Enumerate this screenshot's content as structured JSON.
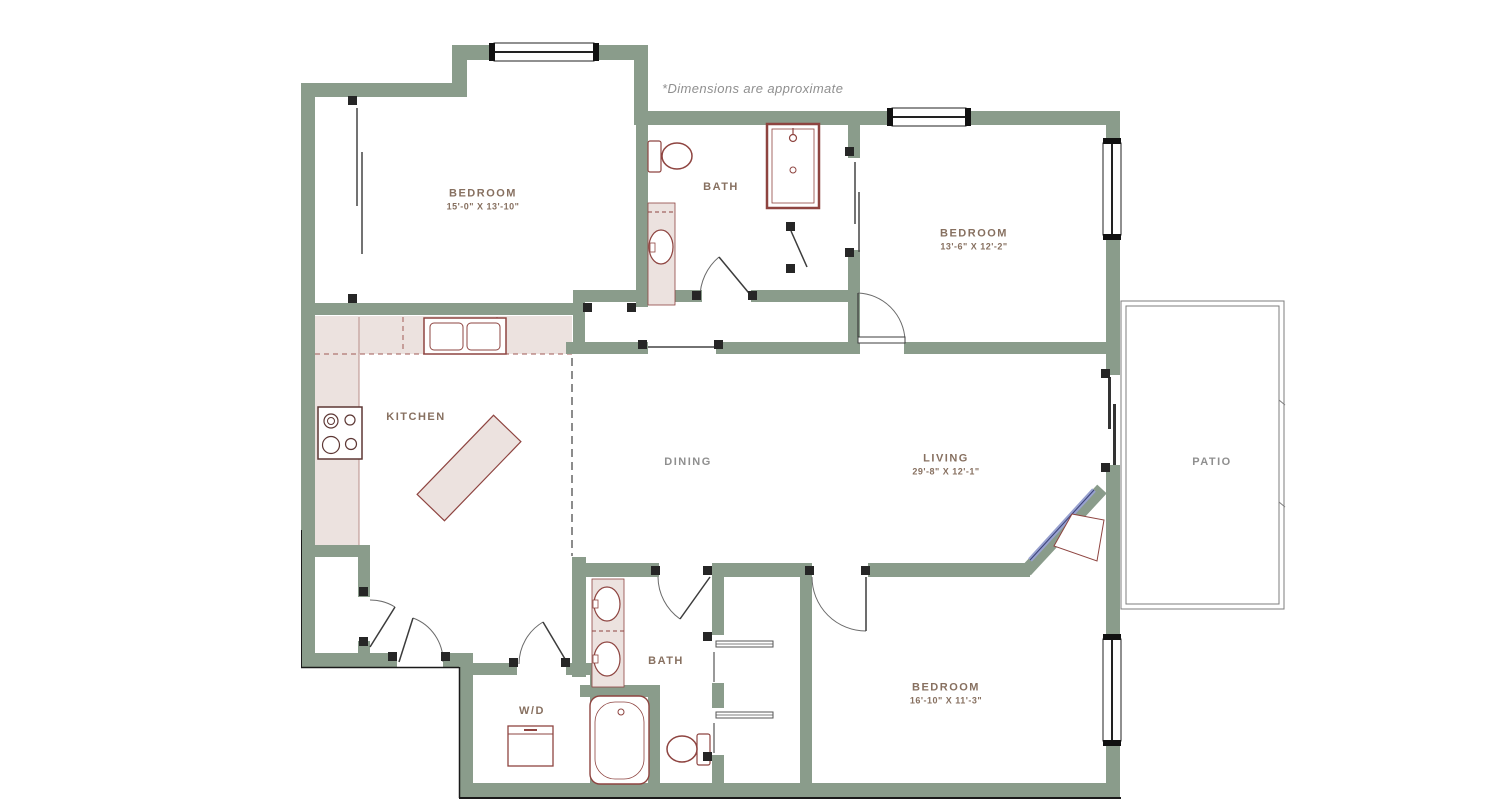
{
  "note": "*Dimensions are approximate",
  "rooms": {
    "bedroom_top_left": {
      "label": "BEDROOM",
      "dims": "15'-0\" X 13'-10\""
    },
    "bath_top": {
      "label": "BATH"
    },
    "bedroom_right": {
      "label": "BEDROOM",
      "dims": "13'-6\" X 12'-2\""
    },
    "kitchen": {
      "label": "KITCHEN"
    },
    "dining": {
      "label": "DINING"
    },
    "living": {
      "label": "LIVING",
      "dims": "29'-8\" X 12'-1\""
    },
    "patio": {
      "label": "PATIO"
    },
    "bath_bottom": {
      "label": "BATH"
    },
    "laundry": {
      "label": "W/D"
    },
    "bedroom_bottom": {
      "label": "BEDROOM",
      "dims": "16'-10\" X 11'-3\""
    }
  },
  "colors": {
    "wall": "#8a9c8b",
    "fixture": "#8e4440",
    "counter_fill": "#ece2df",
    "label_brown": "#877060",
    "label_gray": "#8f8f8f",
    "fireplace_glass": "#98a1cf",
    "patio_line": "#7d7d7d"
  }
}
